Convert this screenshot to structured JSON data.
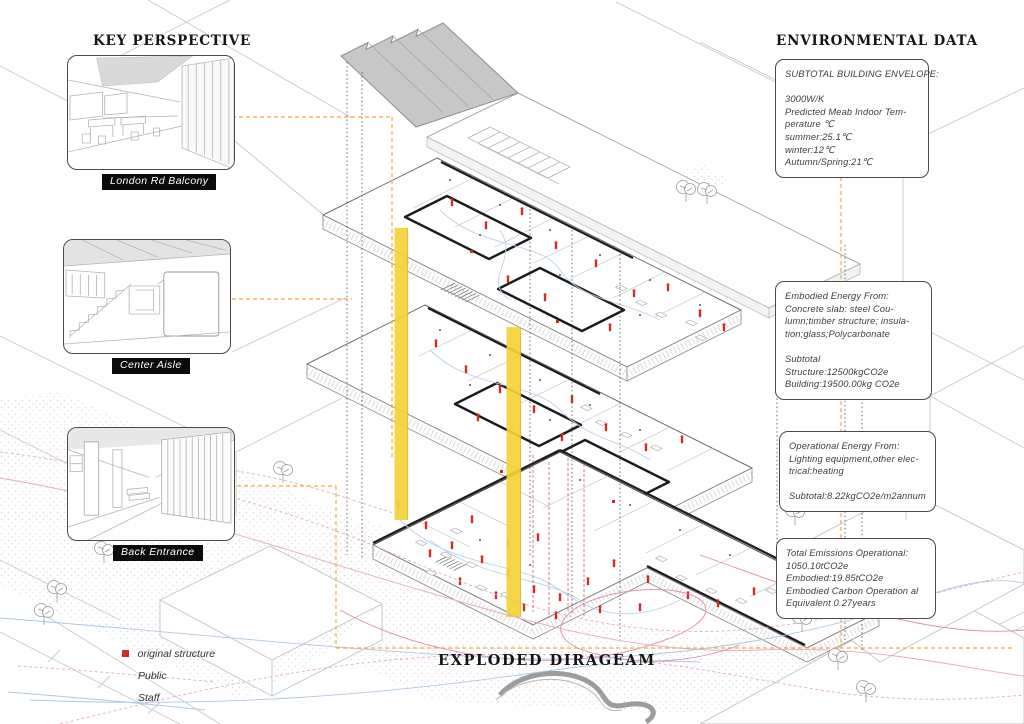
{
  "titles": {
    "key_perspective": "KEY PERSPECTIVE",
    "environmental_data": "ENVIRONMENTAL DATA",
    "exploded_diagram": "EXPLODED DIRAGEAM"
  },
  "perspectives": [
    {
      "label": "London Rd Balcony"
    },
    {
      "label": "Center Aisle"
    },
    {
      "label": "Back Entrance"
    }
  ],
  "env_boxes": [
    {
      "lines": [
        "SUBTOTAL BUILDING ENVELOPE:",
        "",
        "3000W/K",
        "Predicted Meab Indoor Tem-",
        "perature ℃",
        "summer:25.1℃",
        "winter:12℃",
        "Autumn/Spring:21℃"
      ]
    },
    {
      "lines": [
        "Embodied Energy From:",
        "Concrete slab: steel Cou-",
        "lumn;timber structure; insula-",
        "tion;glass;Polycarbonate",
        "",
        "Subtotal",
        "Structure:12500kgCO2e",
        "Building:19500.00kg CO2e"
      ]
    },
    {
      "lines": [
        "Operational Energy From:",
        "Lighting equipment,other elec-",
        "trical:heating",
        "",
        "Subtotal:8.22kgCO2e/m2annum"
      ]
    },
    {
      "lines": [
        "Total Emissions Operational:",
        "1050.10tCO2e",
        "Embodied:19.85tCO2e",
        "Embodied Carbon Operation al",
        "Equivalent 0.27years"
      ]
    }
  ],
  "legend": {
    "items": [
      {
        "label": "original structure",
        "marker": "red-square"
      },
      {
        "label": "Public",
        "marker": "pink-dashed-line"
      },
      {
        "label": "Staff",
        "marker": "blue-line"
      }
    ]
  },
  "colors": {
    "accent_yellow": "#f5d338",
    "accent_orange": "#f2a93b",
    "figure_red": "#cf2b20",
    "flow_public_pink": "#e9a6c4",
    "flow_staff_blue": "#abc8e6"
  }
}
